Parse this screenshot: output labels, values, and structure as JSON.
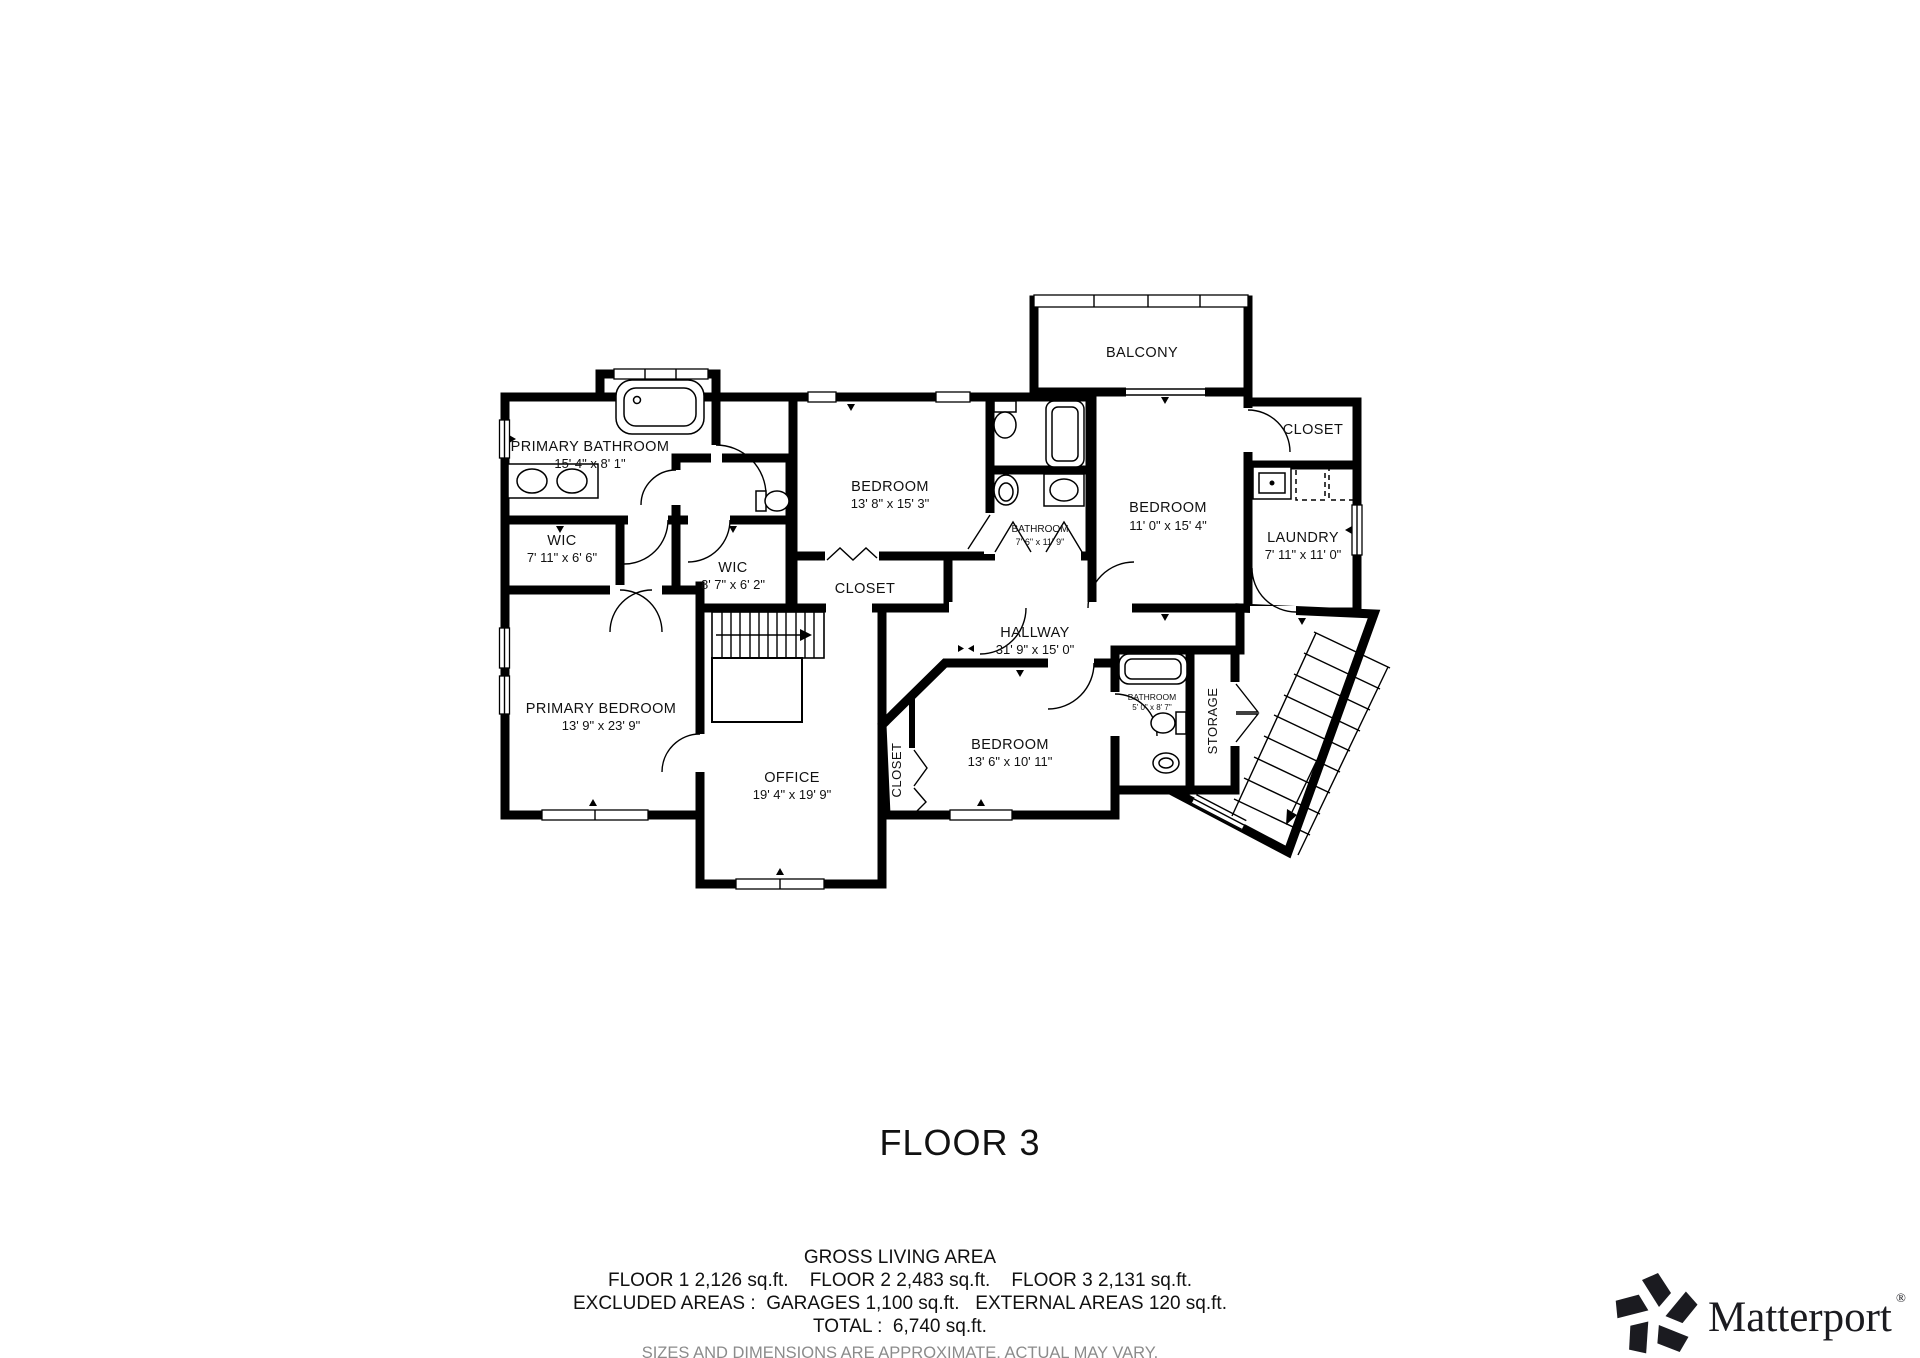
{
  "title": "FLOOR 3",
  "rooms": {
    "primary_bathroom": {
      "name": "PRIMARY BATHROOM",
      "dims": "15' 4\" x 8' 1\""
    },
    "wic_a": {
      "name": "WIC",
      "dims": "7' 11\" x 6' 6\""
    },
    "wic_b": {
      "name": "WIC",
      "dims": "8' 7\" x 6' 2\""
    },
    "bedroom_top": {
      "name": "BEDROOM",
      "dims": "13' 8\" x 15' 3\""
    },
    "closet_mid": {
      "name": "CLOSET"
    },
    "bathroom_top": {
      "name": "BATHROOM",
      "dims": "7' 6\" x 11' 9\""
    },
    "bedroom_right": {
      "name": "BEDROOM",
      "dims": "11' 0\" x 15' 4\""
    },
    "balcony": {
      "name": "BALCONY"
    },
    "closet_right": {
      "name": "CLOSET"
    },
    "laundry": {
      "name": "LAUNDRY",
      "dims": "7' 11\" x 11' 0\""
    },
    "hallway": {
      "name": "HALLWAY",
      "dims": "31' 9\" x 15' 0\""
    },
    "primary_bedroom": {
      "name": "PRIMARY BEDROOM",
      "dims": "13' 9\" x 23' 9\""
    },
    "office": {
      "name": "OFFICE",
      "dims": "19' 4\" x 19' 9\""
    },
    "closet_lower": {
      "name": "CLOSET"
    },
    "bedroom_lower": {
      "name": "BEDROOM",
      "dims": "13' 6\" x 10' 11\""
    },
    "bathroom_lower": {
      "name": "BATHROOM",
      "dims": "5' 0\" x 8' 7\""
    },
    "storage": {
      "name": "STORAGE"
    }
  },
  "footer": {
    "gross_title": "GROSS LIVING AREA",
    "floors_line": "FLOOR 1 2,126 sq.ft.    FLOOR 2 2,483 sq.ft.    FLOOR 3 2,131 sq.ft.",
    "excluded_line": "EXCLUDED AREAS :  GARAGES 1,100 sq.ft.   EXTERNAL AREAS 120 sq.ft.",
    "total_line": "TOTAL :  6,740 sq.ft.",
    "disclaimer": "SIZES AND DIMENSIONS ARE APPROXIMATE, ACTUAL MAY VARY."
  },
  "branding": {
    "logo_text": "Matterport",
    "registered_mark": "®"
  },
  "colors": {
    "wall": "#000000",
    "text": "#111111",
    "disclaimer_text": "#8b8b8b",
    "background": "#ffffff"
  }
}
